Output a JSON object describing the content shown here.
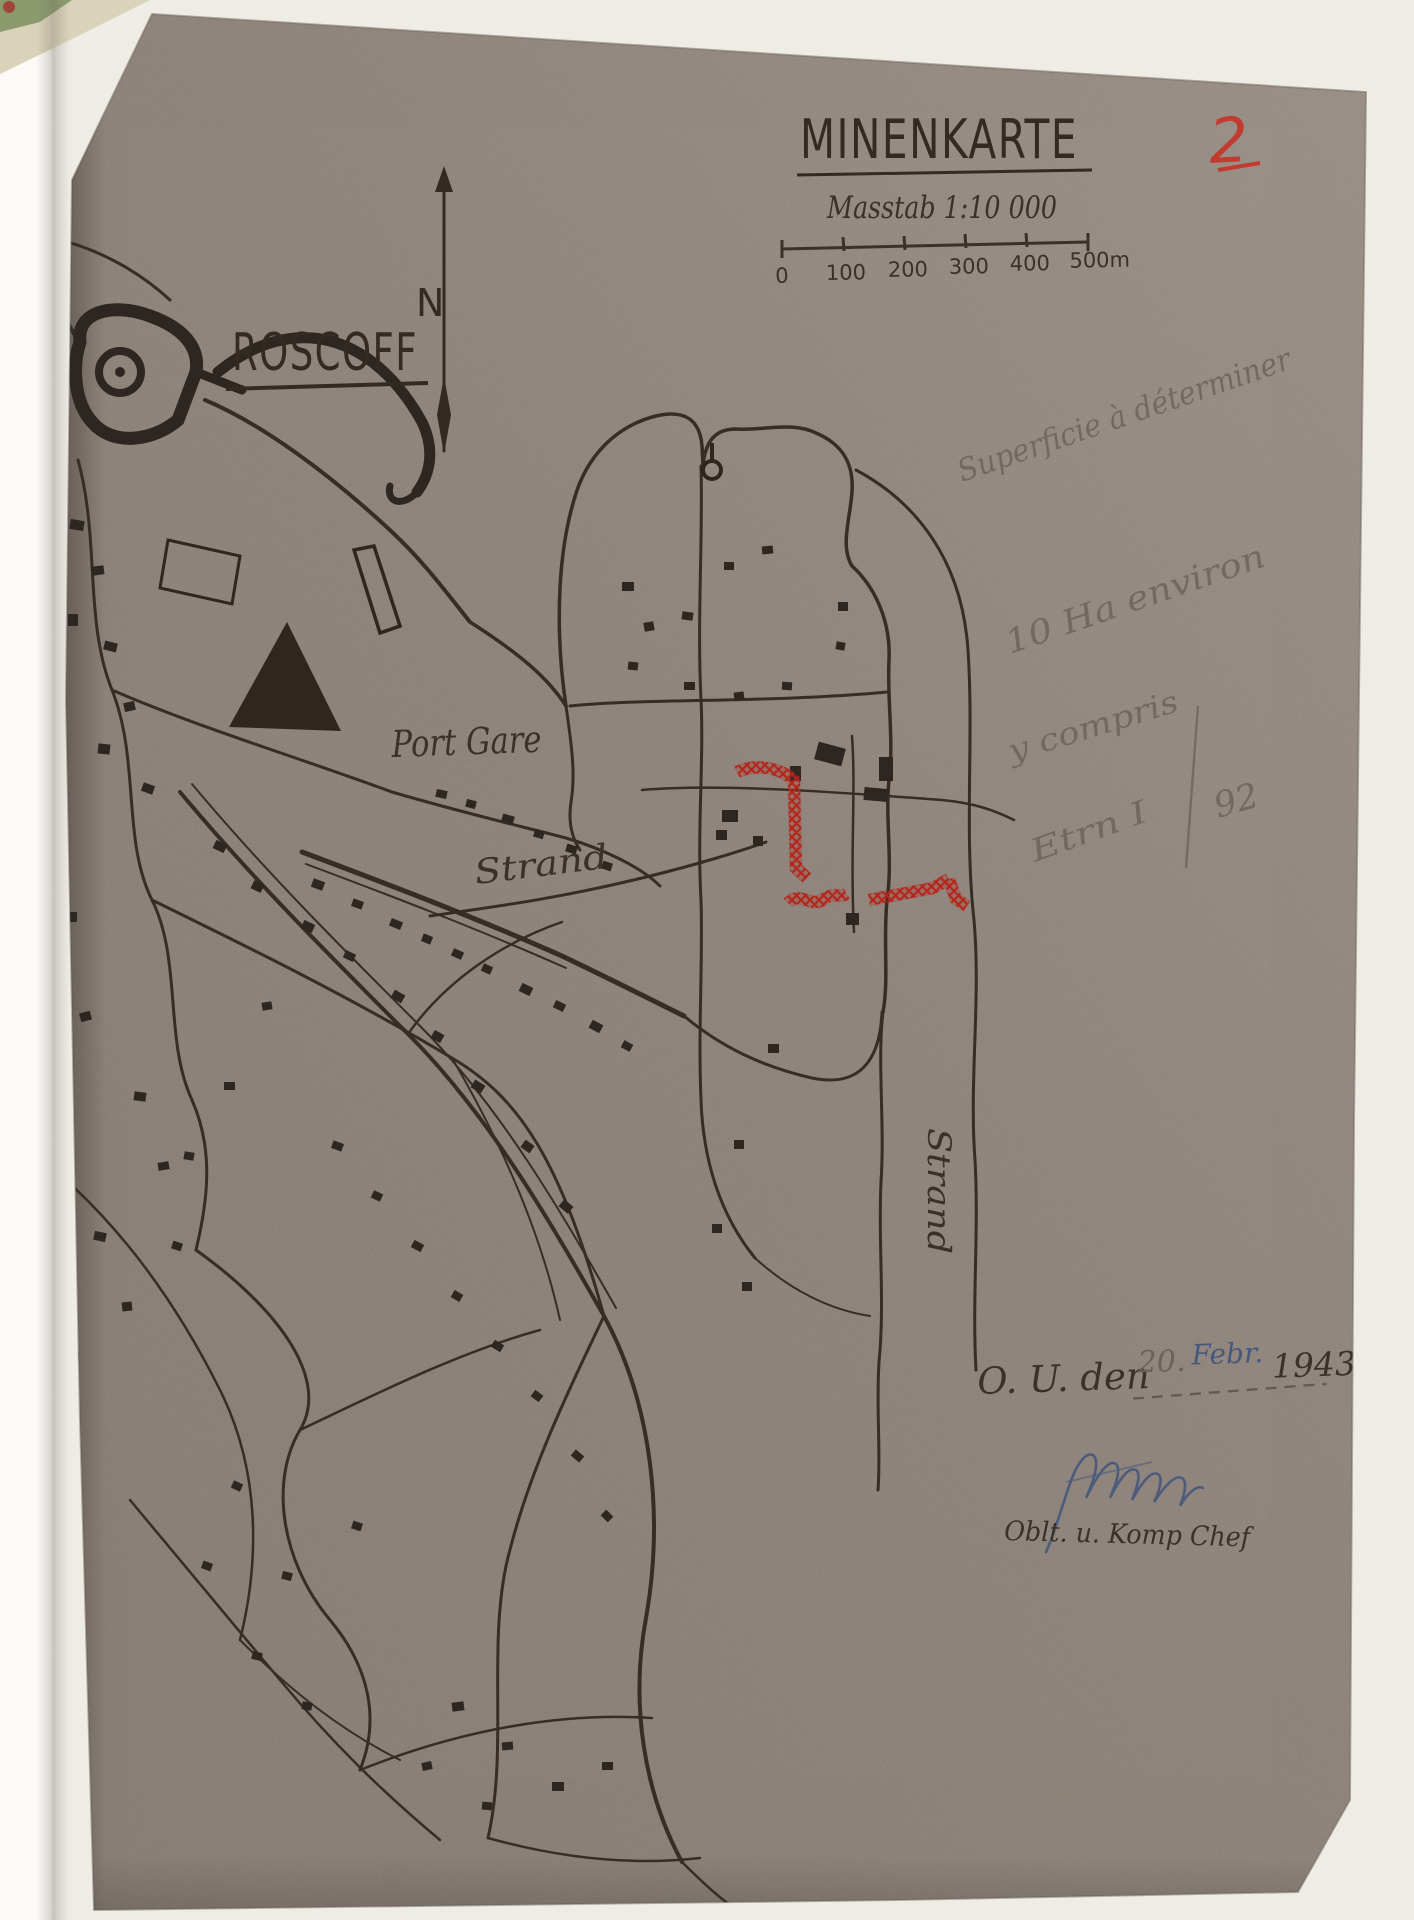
{
  "photo": {
    "background": "#efece5",
    "paper_color": "#8d8279"
  },
  "header": {
    "title": "MINENKARTE",
    "page_number": "2",
    "scale_label": "Masstab 1:10 000",
    "scale_ticks": [
      "0",
      "100",
      "200",
      "300",
      "400",
      "500m"
    ]
  },
  "compass": {
    "north_label": "N"
  },
  "map_labels": {
    "town": "ROSCOFF",
    "port": "Port Gare",
    "strand_west": "Strand",
    "strand_east": "Strand"
  },
  "pencil_notes": {
    "line1": "Superficie à déterminer",
    "line2": "10 Ha environ",
    "line3": "y compris",
    "line4_left": "Etrn I",
    "line4_right": "92"
  },
  "footer": {
    "date_prefix": "O. U. den",
    "date_day": "20.",
    "date_month": "Febr.",
    "date_year": "1943",
    "signer_role": "Oblt. u. Komp Chef"
  },
  "colors": {
    "ink": "#362d25",
    "mine_red": "#b5251a",
    "pencil": "#6b6156",
    "blue_ink": "#46587d",
    "page_number_red": "#c23b30"
  }
}
